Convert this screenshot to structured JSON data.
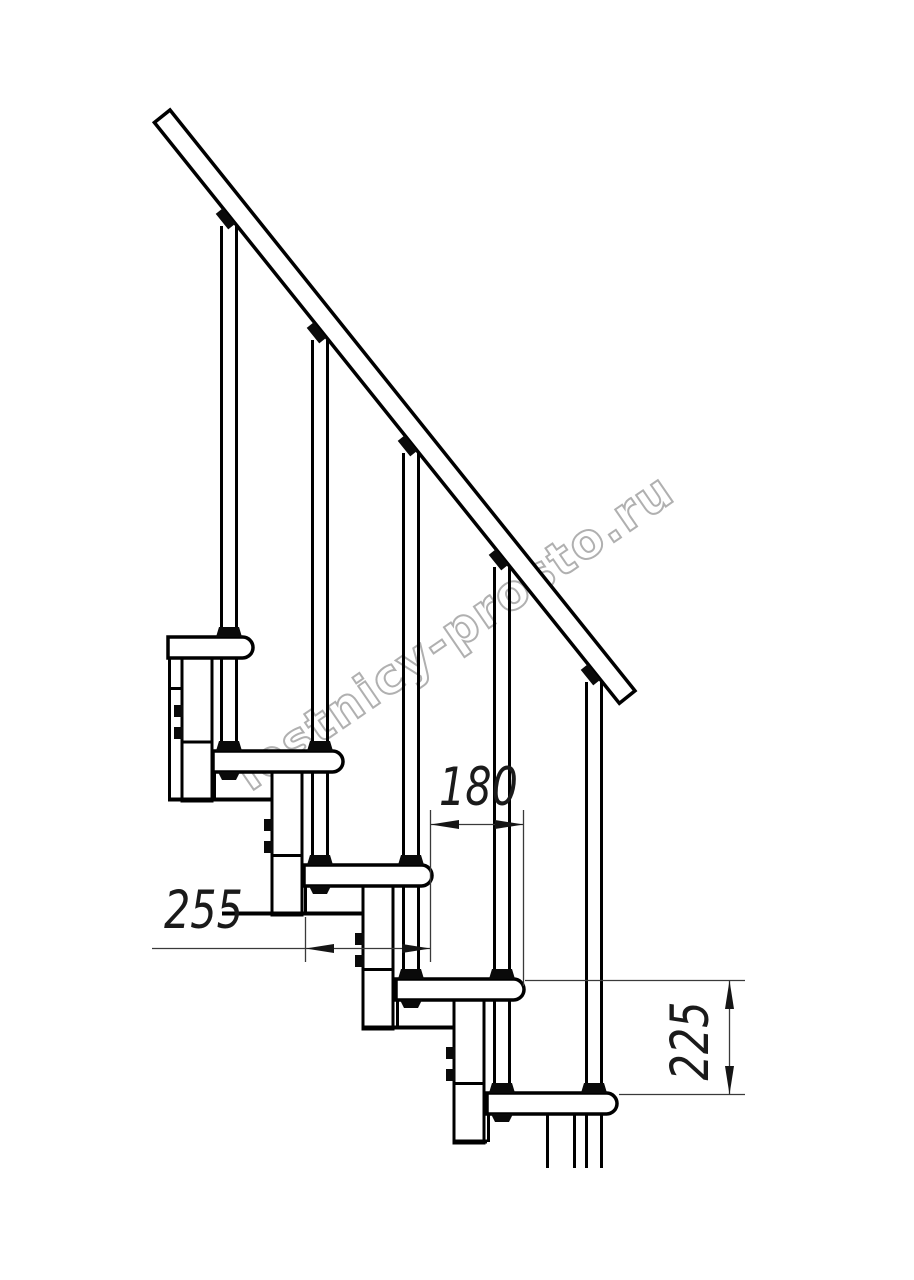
{
  "drawing": {
    "description": "Modular staircase side-view technical drawing, five treads with handrail",
    "background": "#ffffff",
    "line_color": "#000000",
    "dimension_line_color": "#3a3a3a"
  },
  "dimensions": {
    "tread_run": {
      "label": "180"
    },
    "tread_depth": {
      "label": "255"
    },
    "step_rise": {
      "label": "225"
    }
  },
  "watermark": {
    "text": "lestnicy-prosto.ru",
    "outline_color": "#b0b0b0"
  }
}
